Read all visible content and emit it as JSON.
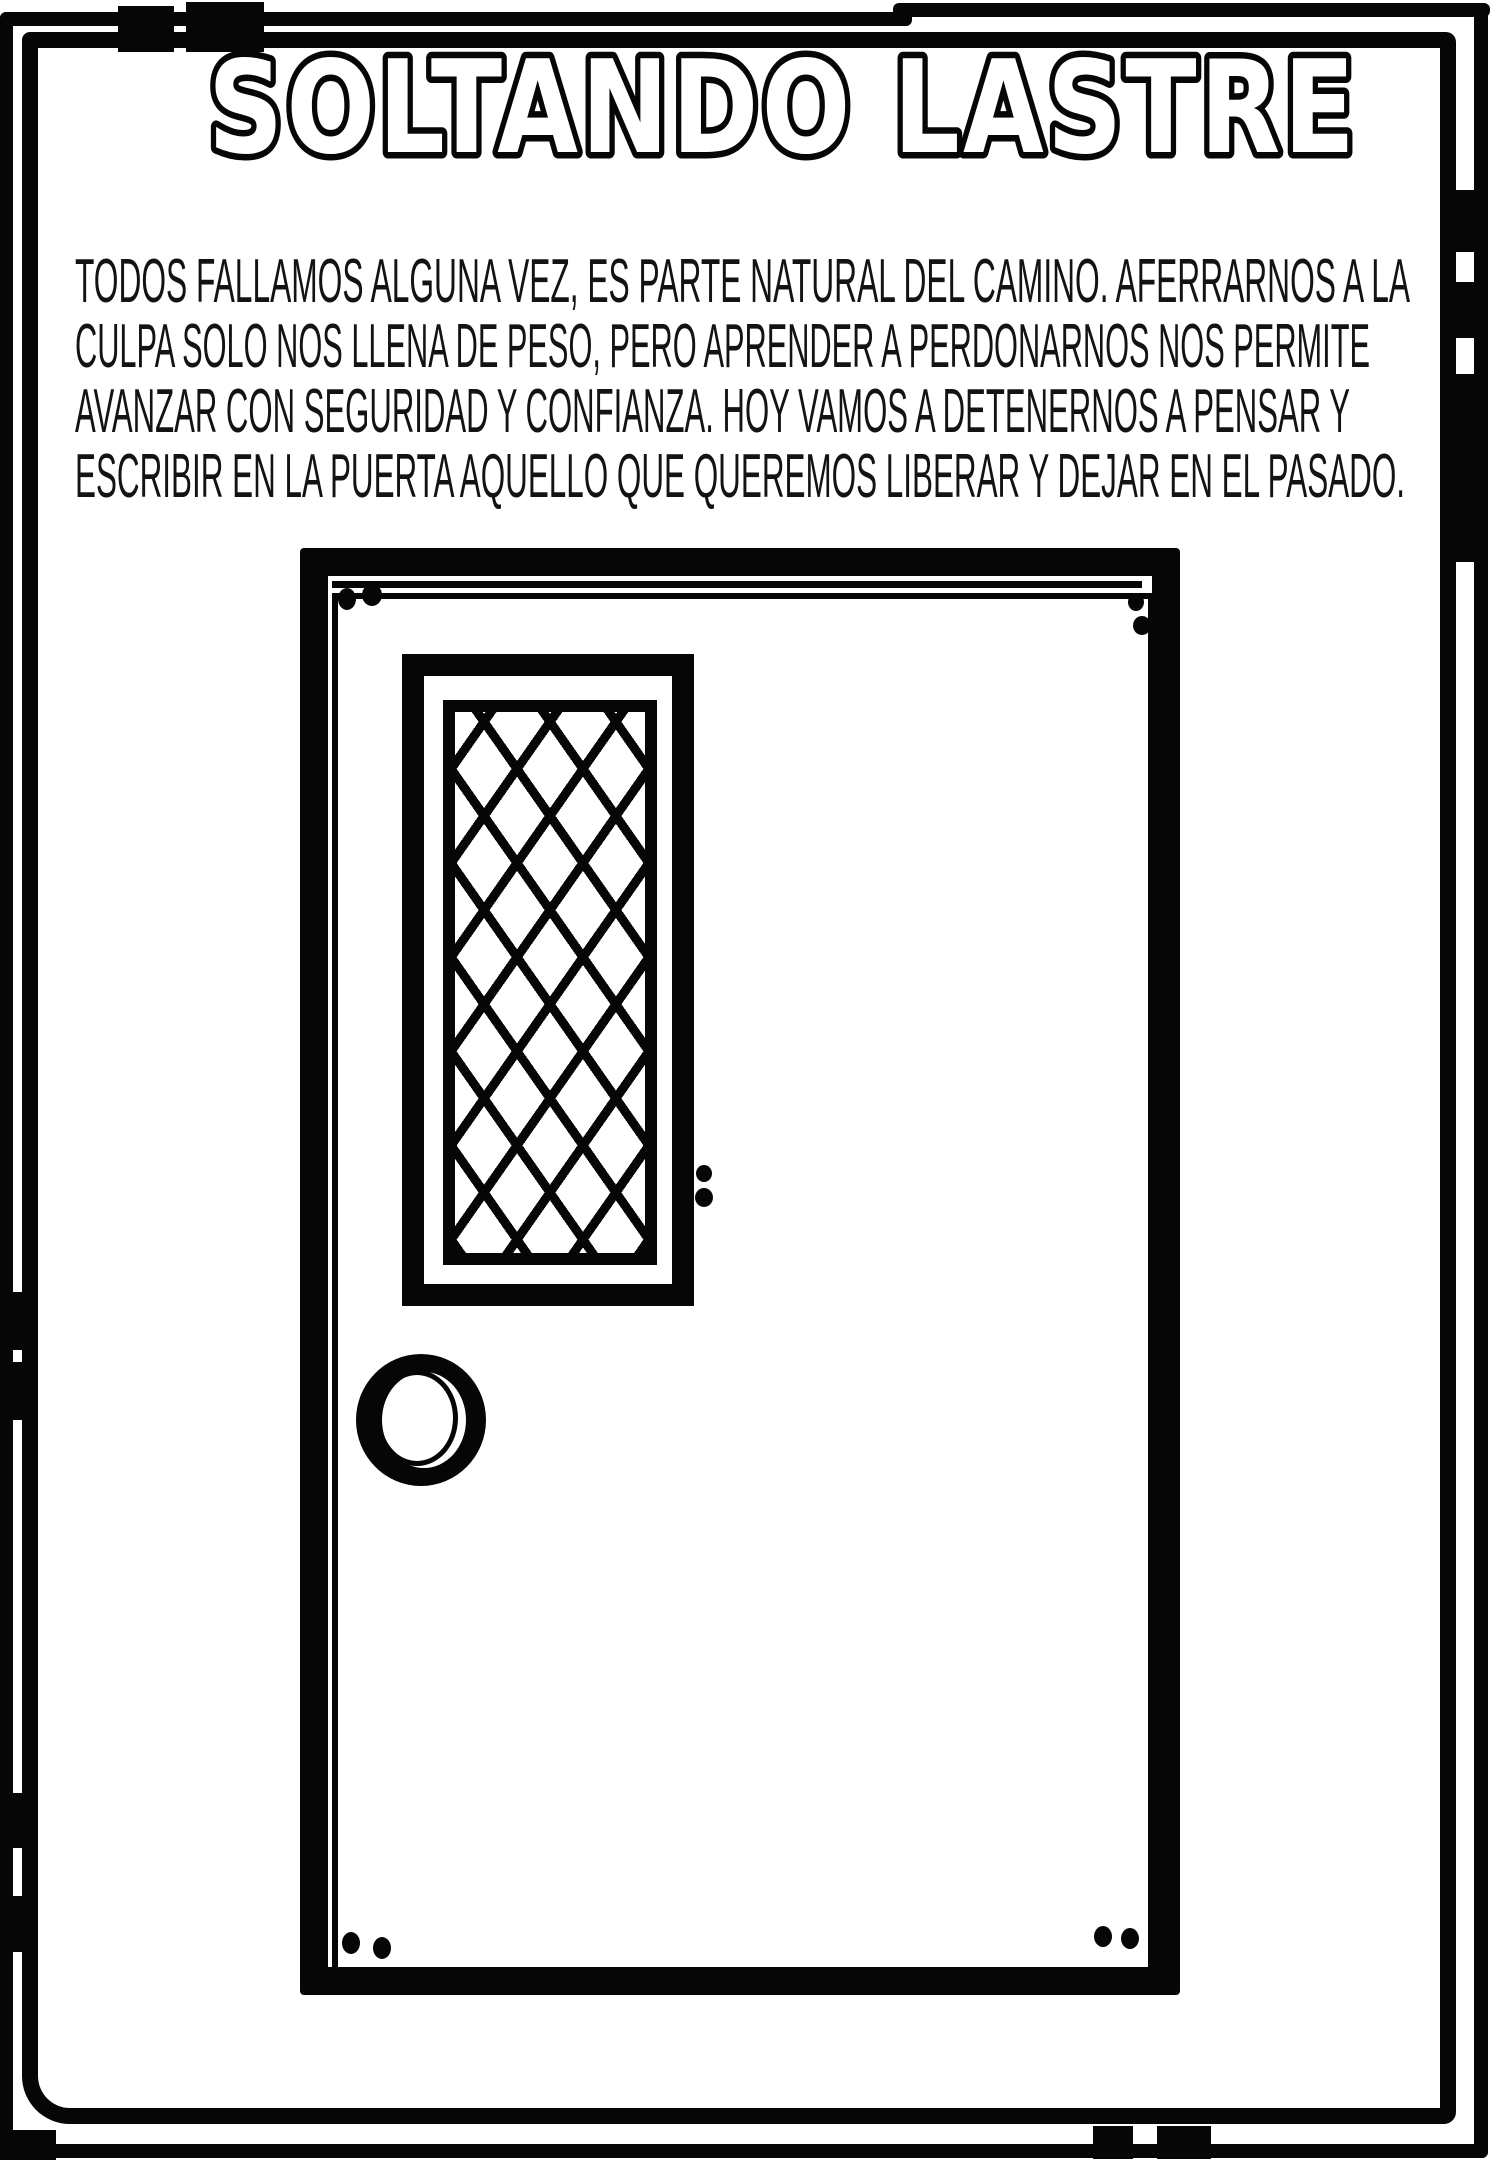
{
  "page": {
    "title": "SOLTANDO LASTRE",
    "paragraph_lines": [
      "TODOS FALLAMOS ALGUNA VEZ, ES PARTE NATURAL DEL CAMINO. AFERRARNOS A LA",
      "CULPA SOLO NOS LLENA DE PESO, PERO APRENDER A PERDONARNOS NOS PERMITE",
      "AVANZAR CON SEGURIDAD Y CONFIANZA. HOY VAMOS A DETENERNOS A PENSAR Y",
      "ESCRIBIR EN LA PUERTA AQUELLO QUE QUEREMOS LIBERAR Y DEJAR EN EL PASADO."
    ],
    "illustration": {
      "name": "door-with-lattice-window-and-knob",
      "writing_area": "blank door panel"
    },
    "colors": {
      "ink": "#060606",
      "paper": "#ffffff"
    }
  }
}
